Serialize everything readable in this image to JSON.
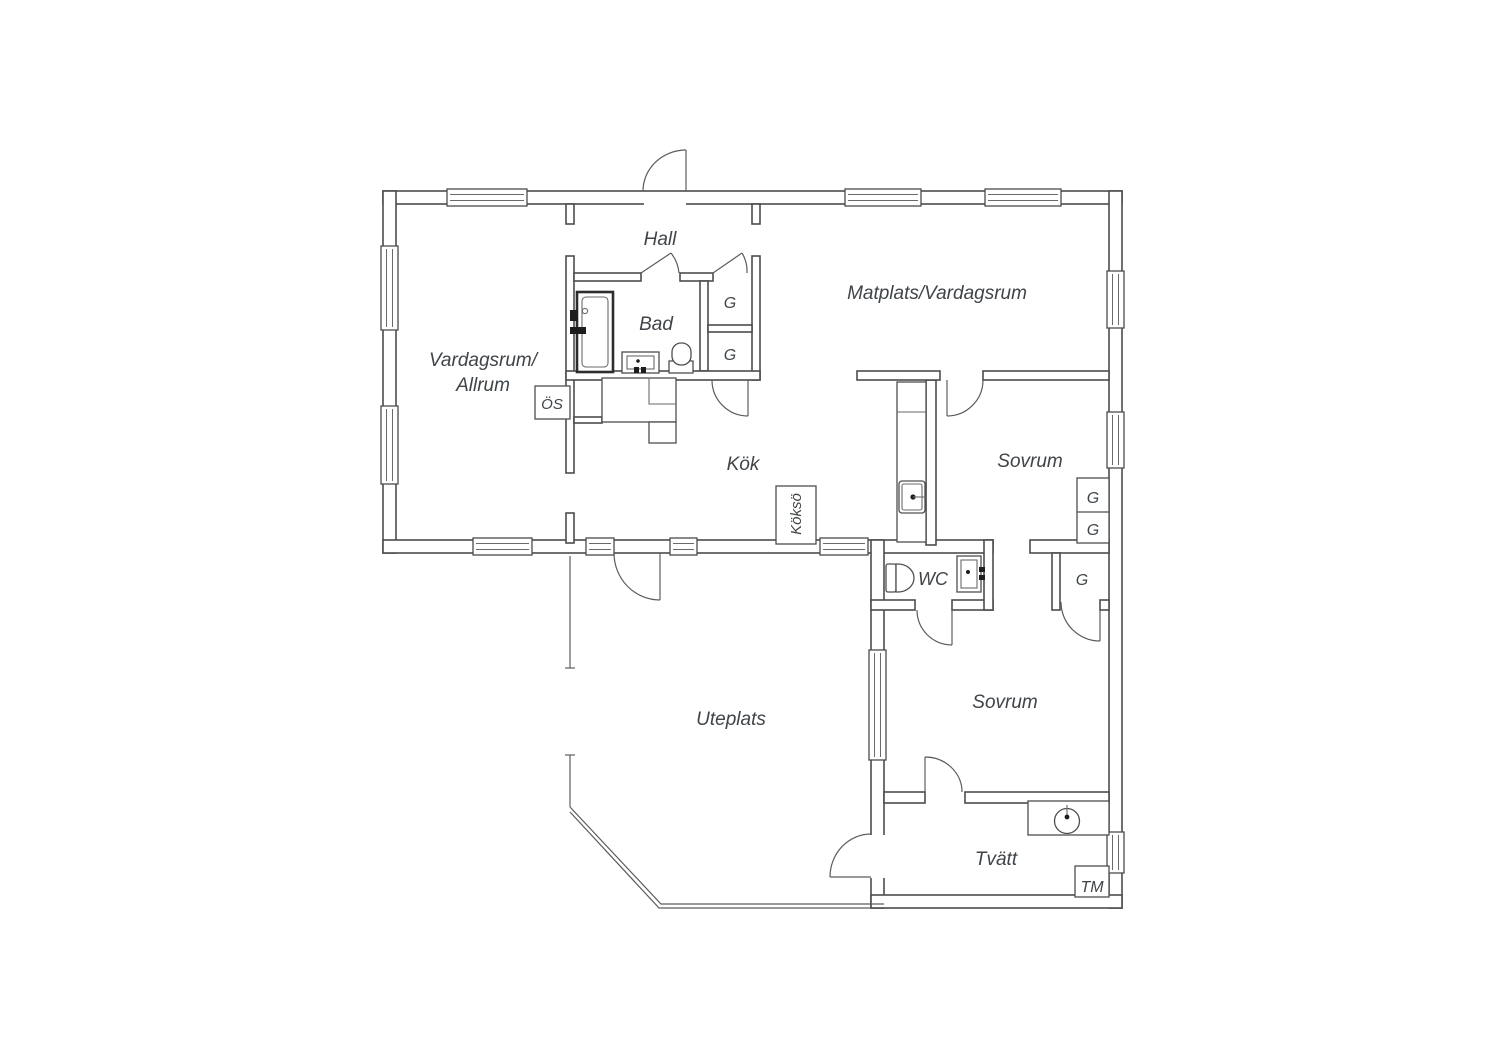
{
  "colors": {
    "background": "#ffffff",
    "wall_line": "#4c4c4c",
    "fixture_line": "#5c5c5c",
    "text": "#3f4448"
  },
  "labels": {
    "hall": "Hall",
    "bad": "Bad",
    "vardagsrum_allrum_line1": "Vardagsrum/",
    "vardagsrum_allrum_line2": "Allrum",
    "matplats_vardagsrum": "Matplats/Vardagsrum",
    "kok": "Kök",
    "sovrum_1": "Sovrum",
    "sovrum_2": "Sovrum",
    "wc": "WC",
    "uteplats": "Uteplats",
    "tvatt": "Tvätt",
    "tm": "TM",
    "os": "ÖS",
    "kokso": "Köksö",
    "g": "G"
  }
}
